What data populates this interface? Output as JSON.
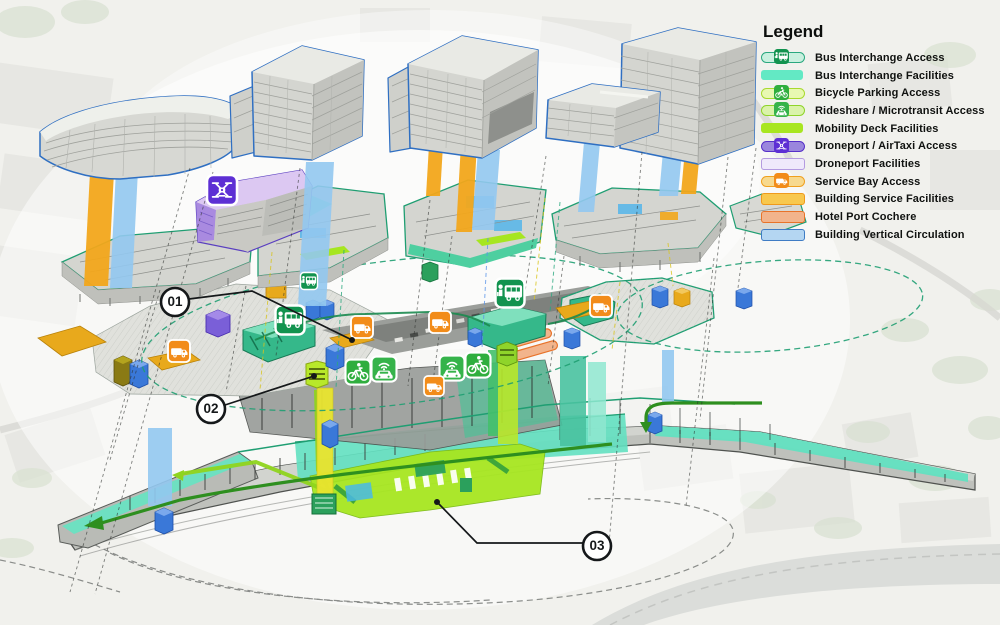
{
  "legend": {
    "title": "Legend",
    "items": [
      {
        "type": "pill-icon",
        "icon": "bus",
        "fill": "#c9f0df",
        "stroke": "#2aa87f",
        "iconBg": "#12934f",
        "label": "Bus Interchange Access"
      },
      {
        "type": "swatch",
        "fill": "#63e9c4",
        "stroke": "none",
        "label": "Bus Interchange Facilities"
      },
      {
        "type": "pill-icon",
        "icon": "bike",
        "fill": "#e8f8b2",
        "stroke": "#a8da2e",
        "iconBg": "#2fae3e",
        "label": "Bicycle Parking Access"
      },
      {
        "type": "pill-icon",
        "icon": "rideshare",
        "fill": "#daf3aa",
        "stroke": "#8fd42a",
        "iconBg": "#35b34a",
        "label": "Rideshare / Microtransit Access"
      },
      {
        "type": "swatch",
        "fill": "#a8e620",
        "stroke": "none",
        "label": "Mobility Deck Facilities"
      },
      {
        "type": "pill-icon",
        "icon": "drone",
        "fill": "#9a86dd",
        "stroke": "#5630c8",
        "iconBg": "#5d2fd4",
        "label": "Droneport  / AirTaxi Access"
      },
      {
        "type": "swatch",
        "fill": "#efe9fb",
        "stroke": "#b49be0",
        "label": "Droneport Facilities"
      },
      {
        "type": "pill-icon",
        "icon": "service",
        "fill": "#f7d98e",
        "stroke": "#f0a01e",
        "iconBg": "#f28c1a",
        "label": "Service Bay Access"
      },
      {
        "type": "swatch",
        "fill": "#f8c84e",
        "stroke": "#ef9a1c",
        "label": "Building Service Facilities"
      },
      {
        "type": "swatch",
        "fill": "#f2b48c",
        "stroke": "#e8732a",
        "label": "Hotel Port Cochere"
      },
      {
        "type": "swatch",
        "fill": "#b4d6f2",
        "stroke": "#3f7cc4",
        "label": "Building Vertical Circulation"
      }
    ]
  },
  "callouts": [
    {
      "label": "01",
      "cx": 175,
      "cy": 302,
      "r": 14,
      "leader": "M 189,299 L 252,291 L 352,340",
      "dot": [
        352,
        340
      ]
    },
    {
      "label": "02",
      "cx": 211,
      "cy": 409,
      "r": 14,
      "leader": "M 225,405 L 314,376",
      "dot": [
        314,
        376
      ]
    },
    {
      "label": "03",
      "cx": 597,
      "cy": 546,
      "r": 14,
      "leader": "M 583,543 L 477,543 L 437,502",
      "dot": [
        437,
        502
      ]
    }
  ],
  "badge_kinds": {
    "bus": {
      "bg": "#12934f",
      "name": "bus-interchange-access-icon"
    },
    "bike": {
      "bg": "#2fae3e",
      "name": "bicycle-parking-access-icon"
    },
    "rideshare": {
      "bg": "#35b34a",
      "name": "rideshare-microtransit-access-icon"
    },
    "drone": {
      "bg": "#5d2fd4",
      "name": "droneport-airtaxi-access-icon"
    },
    "service": {
      "bg": "#f28c1a",
      "name": "service-bay-access-icon"
    }
  },
  "badges": [
    {
      "kind": "drone",
      "x": 222,
      "y": 190,
      "s": 30
    },
    {
      "kind": "bus",
      "x": 309,
      "y": 281,
      "s": 17
    },
    {
      "kind": "bus",
      "x": 290,
      "y": 320,
      "s": 29
    },
    {
      "kind": "bus",
      "x": 510,
      "y": 293,
      "s": 29
    },
    {
      "kind": "bike",
      "x": 358,
      "y": 372,
      "s": 25
    },
    {
      "kind": "rideshare",
      "x": 384,
      "y": 369,
      "s": 25
    },
    {
      "kind": "rideshare",
      "x": 452,
      "y": 368,
      "s": 25
    },
    {
      "kind": "bike",
      "x": 478,
      "y": 365,
      "s": 25
    },
    {
      "kind": "service",
      "x": 179,
      "y": 351,
      "s": 22
    },
    {
      "kind": "service",
      "x": 362,
      "y": 327,
      "s": 22
    },
    {
      "kind": "service",
      "x": 440,
      "y": 322,
      "s": 22
    },
    {
      "kind": "service",
      "x": 601,
      "y": 306,
      "s": 22
    },
    {
      "kind": "service",
      "x": 434,
      "y": 386,
      "s": 20
    }
  ],
  "palette": {
    "bus_access": "#12934f",
    "bus_facilities": "#63e9c4",
    "bicycle_access": "#2fae3e",
    "rideshare_access": "#35b34a",
    "mobility_deck": "#a8e620",
    "droneport_access": "#5d2fd4",
    "droneport_facilities": "#efe9fb",
    "service_bay": "#f28c1a",
    "building_service": "#f8c84e",
    "hotel_cochere": "#f2b48c",
    "vertical_circulation": "#b4d6f2",
    "tower_outline": "#2f6fc2",
    "podium_outline": "#1f9e72",
    "band_orange": "#f2a71b",
    "band_blue": "#92c8f0",
    "arrow_green": "#2e8f1f"
  }
}
